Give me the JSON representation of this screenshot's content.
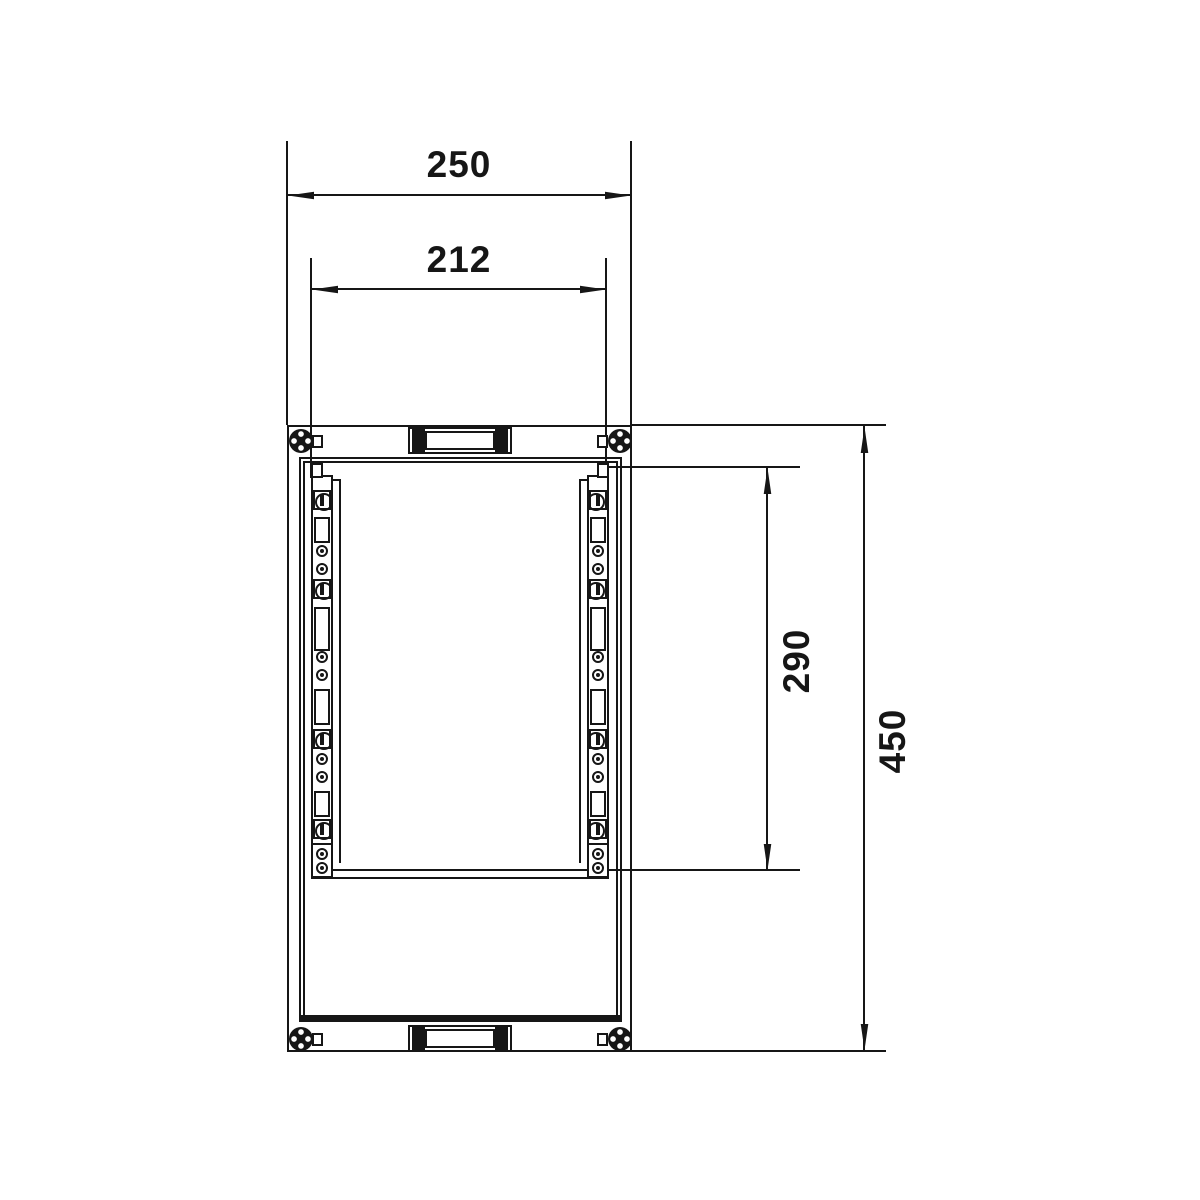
{
  "drawing": {
    "background": "#ffffff",
    "line_color": "#161616"
  },
  "dimensions": {
    "outer_width": {
      "value": "250"
    },
    "inner_width": {
      "value": "212"
    },
    "inner_height": {
      "value": "290"
    },
    "outer_height": {
      "value": "450"
    }
  },
  "rails": {
    "elements": [
      {
        "type": "screw",
        "y": 37
      },
      {
        "type": "slot",
        "y": 54,
        "h": 26
      },
      {
        "type": "hole",
        "y": 88
      },
      {
        "type": "hole",
        "y": 106
      },
      {
        "type": "screw",
        "y": 126
      },
      {
        "type": "slot",
        "y": 144,
        "h": 44
      },
      {
        "type": "hole",
        "y": 194
      },
      {
        "type": "hole",
        "y": 212
      },
      {
        "type": "slot",
        "y": 226,
        "h": 36
      },
      {
        "type": "screw",
        "y": 276
      },
      {
        "type": "hole",
        "y": 296
      },
      {
        "type": "hole",
        "y": 314
      },
      {
        "type": "slot",
        "y": 328,
        "h": 26
      },
      {
        "type": "screw",
        "y": 366
      },
      {
        "type": "hole",
        "y": 391
      },
      {
        "type": "hole",
        "y": 405
      }
    ]
  }
}
